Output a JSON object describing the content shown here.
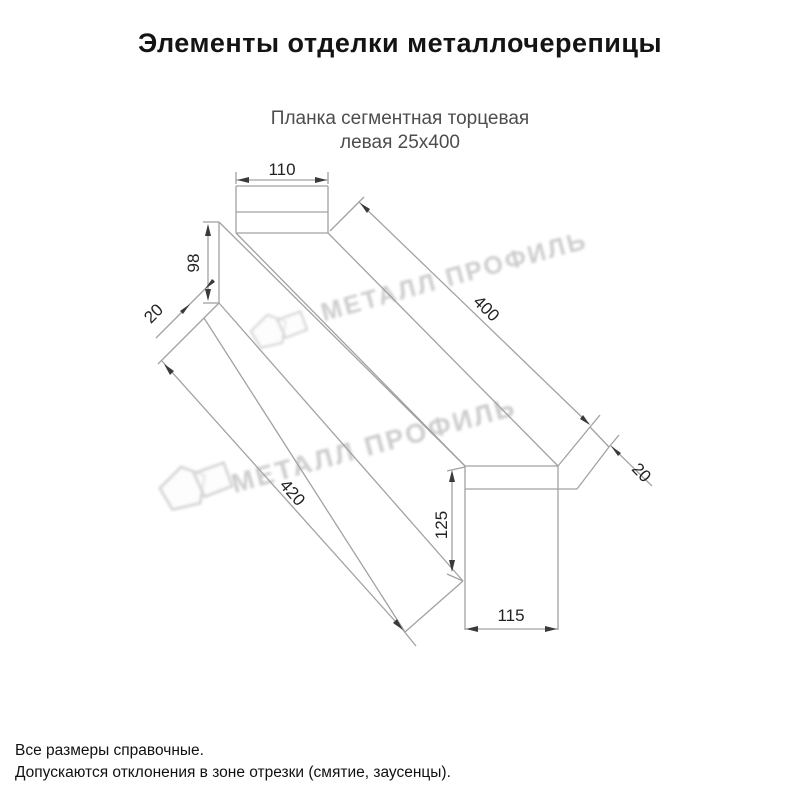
{
  "header": {
    "title": "Элементы отделки металлочерепицы"
  },
  "product": {
    "subtitle_line1": "Планка сегментная торцевая",
    "subtitle_line2": "левая 25х400"
  },
  "watermark": {
    "text": "МЕТАЛЛ ПРОФИЛЬ",
    "color": "#c4c4c4"
  },
  "drawing": {
    "type": "isometric-profile-drawing",
    "line_color": "#a2a2a2",
    "dim_text_color": "#222222",
    "dimensions": [
      {
        "value": "110",
        "x": 282,
        "y": 170,
        "angle": 0
      },
      {
        "value": "98",
        "x": 194,
        "y": 263,
        "angle": -90
      },
      {
        "value": "20",
        "x": 154,
        "y": 314,
        "angle": -45
      },
      {
        "value": "400",
        "x": 486,
        "y": 309,
        "angle": 44
      },
      {
        "value": "20",
        "x": 641,
        "y": 473,
        "angle": 46
      },
      {
        "value": "420",
        "x": 292,
        "y": 493,
        "angle": 49
      },
      {
        "value": "125",
        "x": 442,
        "y": 525,
        "angle": -90
      },
      {
        "value": "115",
        "x": 511,
        "y": 616,
        "angle": 0
      }
    ]
  },
  "footer": {
    "note_line1": "Все размеры справочные.",
    "note_line2": "Допускаются отклонения в зоне отрезки (смятие, заусенцы)."
  }
}
